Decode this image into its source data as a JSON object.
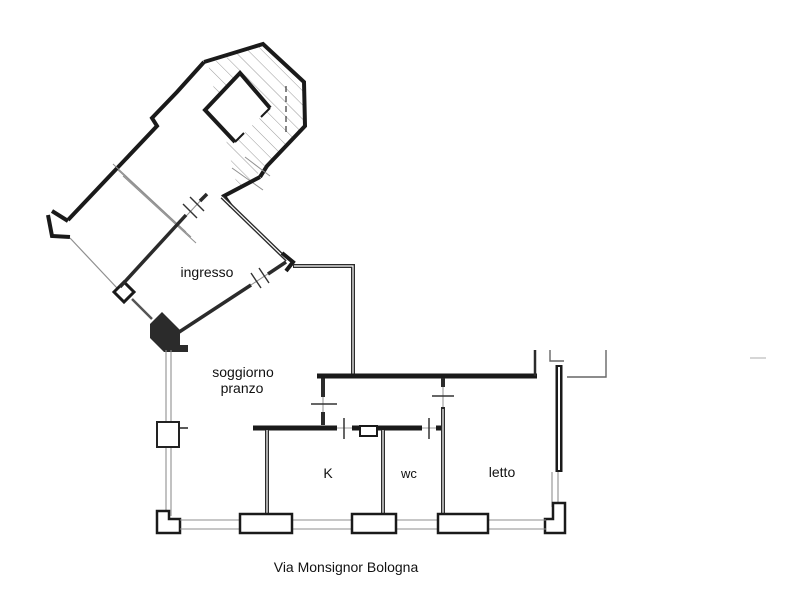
{
  "plan": {
    "rooms": {
      "ingresso": "ingresso",
      "soggiorno_line1": "soggiorno",
      "soggiorno_line2": "pranzo",
      "kitchen": "K",
      "wc": "wc",
      "letto": "letto"
    },
    "caption": "Via Monsignor Bologna",
    "colors": {
      "wall_dark": "#1a1a1a",
      "partition": "#2b2b2b",
      "thin_gray": "#8f8f8f",
      "hatch_gray": "#9a9a9a",
      "background": "#ffffff",
      "text": "#111111"
    }
  }
}
